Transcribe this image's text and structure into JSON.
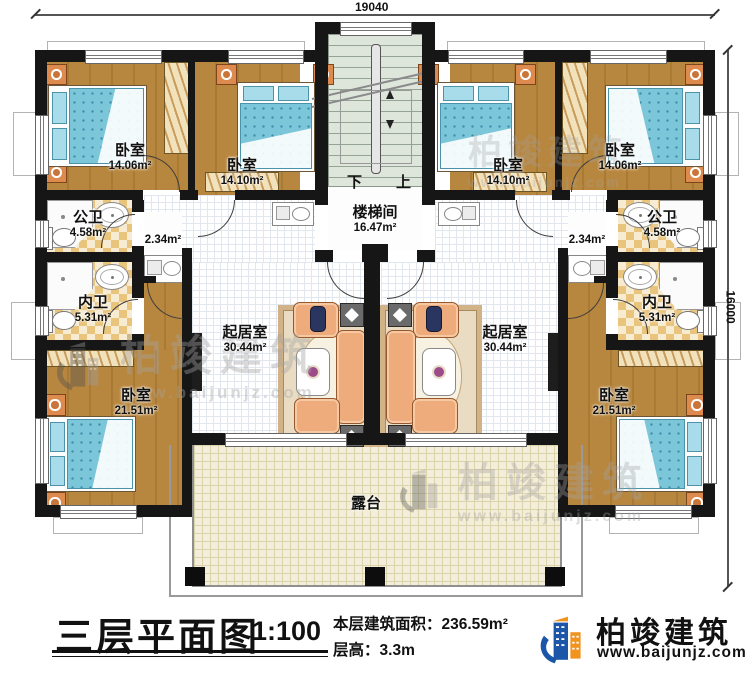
{
  "dimensions": {
    "top": "19040",
    "right": "16000"
  },
  "stair": {
    "down": "下",
    "up": "上"
  },
  "rooms": [
    {
      "name": "卧室",
      "area": "14.06m²"
    },
    {
      "name": "卧室",
      "area": "14.10m²"
    },
    {
      "name": "卧室",
      "area": "14.10m²"
    },
    {
      "name": "卧室",
      "area": "14.06m²"
    },
    {
      "name": "公卫",
      "area": "4.58m²"
    },
    {
      "name": "公卫",
      "area": "4.58m²"
    },
    {
      "name": "内卫",
      "area": "5.31m²"
    },
    {
      "name": "内卫",
      "area": "5.31m²"
    },
    {
      "name": "",
      "area": "2.34m²"
    },
    {
      "name": "",
      "area": "2.34m²"
    },
    {
      "name": "卧室",
      "area": "21.51m²"
    },
    {
      "name": "卧室",
      "area": "21.51m²"
    },
    {
      "name": "起居室",
      "area": "30.44m²"
    },
    {
      "name": "起居室",
      "area": "30.44m²"
    },
    {
      "name": "楼梯间",
      "area": "16.47m²"
    },
    {
      "name": "露台",
      "area": ""
    }
  ],
  "footer": {
    "title": "三层平面图",
    "scale": "1:100",
    "area_label": "本层建筑面积：",
    "area_value": "236.59m²",
    "floor_height_label": "层高：",
    "floor_height_value": "3.3m"
  },
  "logo": {
    "brand": "柏竣建筑",
    "url": "www.baijunjz.com"
  },
  "watermark": {
    "brand": "柏竣建筑",
    "url": "www.baijunjz.com"
  },
  "colors": {
    "wall": "#161616",
    "wood_floor": "#b8873f",
    "bed_blue": "#7cc6da",
    "bath_tile": "#e9c47c",
    "terrace": "#f2eed9",
    "stair_green": "#dee6dc",
    "logo_blue": "#1b56a8",
    "logo_orange": "#f0931f"
  }
}
